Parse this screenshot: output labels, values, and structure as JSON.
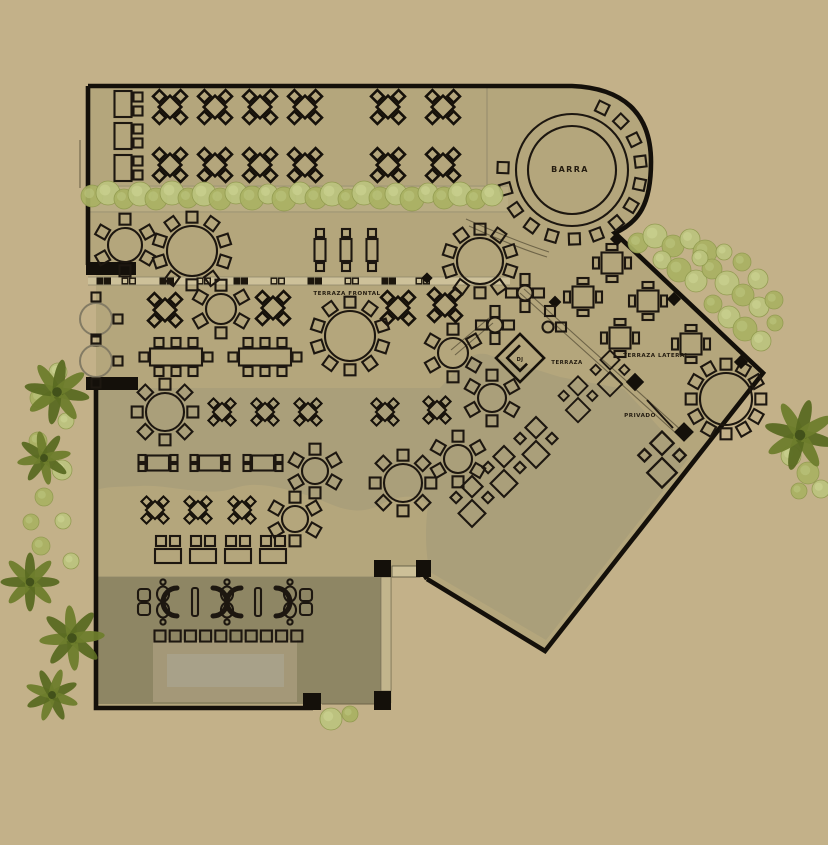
{
  "colors": {
    "page_bg": "#c3b189",
    "interior": "#b4a67c",
    "zone_gray": "#aa9f7a",
    "lounge_zone": "#8e8664",
    "stage_outer": "#a49878",
    "stage_inner": "#a8a189",
    "hedge_band": "#c0b289",
    "divider_strip": "#cdc19a",
    "door_strip": "#c2b58c",
    "line_dark": "#14100a",
    "bush_a": "#aab263",
    "bush_b": "#bcc47f",
    "palm": "#5a6a22"
  },
  "labels": {
    "barra": {
      "text": "BARRA",
      "x": 570,
      "y": 172,
      "size": 8
    },
    "terraza_frontal": {
      "text": "TERRAZA FRONTAL",
      "x": 347,
      "y": 295,
      "size": 5.6
    },
    "terraza": {
      "text": "TERRAZA",
      "x": 567,
      "y": 364,
      "size": 5.4
    },
    "terraza_lateral": {
      "text": "TERRAZA LATERAL",
      "x": 656,
      "y": 357,
      "size": 5.6
    },
    "privado": {
      "text": "PRIVADO",
      "x": 640,
      "y": 417,
      "size": 5.6
    },
    "dj": {
      "text": "DJ",
      "x": 520,
      "y": 361,
      "size": 5
    }
  },
  "furniture": {
    "diamond_tables": [
      {
        "x": 170,
        "y": 107
      },
      {
        "x": 215,
        "y": 107
      },
      {
        "x": 260,
        "y": 107
      },
      {
        "x": 305,
        "y": 107
      },
      {
        "x": 388,
        "y": 107
      },
      {
        "x": 443,
        "y": 107
      },
      {
        "x": 170,
        "y": 165
      },
      {
        "x": 215,
        "y": 165
      },
      {
        "x": 260,
        "y": 165
      },
      {
        "x": 305,
        "y": 165
      },
      {
        "x": 388,
        "y": 165
      },
      {
        "x": 443,
        "y": 165
      },
      {
        "x": 165,
        "y": 310
      },
      {
        "x": 273,
        "y": 308
      },
      {
        "x": 398,
        "y": 308
      },
      {
        "x": 445,
        "y": 305
      },
      {
        "x": 222,
        "y": 412,
        "s": 0.8
      },
      {
        "x": 265,
        "y": 412,
        "s": 0.8
      },
      {
        "x": 308,
        "y": 412,
        "s": 0.8
      },
      {
        "x": 385,
        "y": 412,
        "s": 0.8
      },
      {
        "x": 437,
        "y": 410,
        "s": 0.8
      },
      {
        "x": 155,
        "y": 510,
        "s": 0.8
      },
      {
        "x": 198,
        "y": 510,
        "s": 0.8
      },
      {
        "x": 242,
        "y": 510,
        "s": 0.8
      }
    ],
    "square_tables": [
      {
        "x": 612,
        "y": 263
      },
      {
        "x": 583,
        "y": 297
      },
      {
        "x": 648,
        "y": 301
      },
      {
        "x": 620,
        "y": 338
      },
      {
        "x": 691,
        "y": 344
      }
    ],
    "round_tables": [
      {
        "x": 125,
        "y": 245,
        "r": 17,
        "chairs": 6
      },
      {
        "x": 192,
        "y": 251,
        "r": 25,
        "chairs": 10
      },
      {
        "x": 480,
        "y": 261,
        "r": 23,
        "chairs": 10
      },
      {
        "x": 221,
        "y": 309,
        "r": 15,
        "chairs": 6
      },
      {
        "x": 350,
        "y": 336,
        "r": 25,
        "chairs": 10
      },
      {
        "x": 453,
        "y": 353,
        "r": 15,
        "chairs": 6
      },
      {
        "x": 165,
        "y": 412,
        "r": 19,
        "chairs": 8
      },
      {
        "x": 315,
        "y": 471,
        "r": 13,
        "chairs": 6
      },
      {
        "x": 403,
        "y": 483,
        "r": 19,
        "chairs": 8
      },
      {
        "x": 295,
        "y": 519,
        "r": 13,
        "chairs": 6
      },
      {
        "x": 492,
        "y": 398,
        "r": 14,
        "chairs": 6
      },
      {
        "x": 458,
        "y": 459,
        "r": 14,
        "chairs": 6
      },
      {
        "x": 726,
        "y": 399,
        "r": 26,
        "chairs": 12
      }
    ],
    "faded_round_tables": [
      {
        "x": 96,
        "y": 319,
        "r": 16
      },
      {
        "x": 96,
        "y": 361,
        "r": 16
      }
    ],
    "hightop_tables": [
      {
        "x": 320,
        "y": 250
      },
      {
        "x": 346,
        "y": 250
      },
      {
        "x": 372,
        "y": 250
      }
    ],
    "side_tables": [
      {
        "x": 158,
        "y": 463
      },
      {
        "x": 210,
        "y": 463
      },
      {
        "x": 263,
        "y": 463
      }
    ],
    "banquet_tables": [
      {
        "x": 176,
        "y": 357
      },
      {
        "x": 265,
        "y": 357
      }
    ],
    "lounge_h": [
      {
        "x": 129,
        "y": 104
      },
      {
        "x": 129,
        "y": 136
      },
      {
        "x": 129,
        "y": 168
      }
    ],
    "lounge_v": [
      {
        "x": 168,
        "y": 553
      },
      {
        "x": 203,
        "y": 553
      },
      {
        "x": 238,
        "y": 553
      },
      {
        "x": 273,
        "y": 553
      }
    ],
    "diag_duos": [
      {
        "x": 536,
        "y": 441
      },
      {
        "x": 504,
        "y": 470
      },
      {
        "x": 472,
        "y": 500
      },
      {
        "x": 610,
        "y": 372,
        "s": 0.9
      },
      {
        "x": 578,
        "y": 398,
        "s": 0.9
      },
      {
        "x": 662,
        "y": 458,
        "s": 1.1
      }
    ],
    "round_cross": [
      {
        "x": 525,
        "y": 293
      },
      {
        "x": 495,
        "y": 325
      }
    ],
    "bar": {
      "x": 572,
      "y": 170,
      "outer_r": 56,
      "inner_r": 44,
      "stool_r": 69,
      "stool_angles": [
        64,
        45,
        26,
        7,
        -12,
        -31,
        -50,
        -69,
        -88,
        -107,
        -126,
        -145,
        -164,
        178
      ]
    },
    "dj": {
      "x": 520,
      "y": 358
    },
    "wall_markers": [
      {
        "x": 617,
        "y": 239,
        "s": 10
      },
      {
        "x": 674,
        "y": 299,
        "s": 10
      },
      {
        "x": 741,
        "y": 362,
        "s": 10
      },
      {
        "x": 635,
        "y": 382,
        "s": 13
      },
      {
        "x": 684,
        "y": 432,
        "s": 14
      },
      {
        "x": 555,
        "y": 302,
        "s": 9
      },
      {
        "x": 427,
        "y": 278,
        "s": 8
      }
    ],
    "divider": {
      "y": 281,
      "x1": 88,
      "x2": 510,
      "pairs": [
        {
          "x": 100,
          "f": 1
        },
        {
          "x": 125,
          "f": 0
        },
        {
          "x": 163,
          "f": 1
        },
        {
          "x": 200,
          "f": 0
        },
        {
          "x": 237,
          "f": 1
        },
        {
          "x": 274,
          "f": 0
        },
        {
          "x": 311,
          "f": 1
        },
        {
          "x": 348,
          "f": 0
        },
        {
          "x": 385,
          "f": 1
        },
        {
          "x": 419,
          "f": 0
        }
      ]
    },
    "stool_row": {
      "y": 636,
      "start": 160,
      "step": 15.2,
      "count": 10
    },
    "sofa_row": {
      "y": 602,
      "items": [
        {
          "t": "sqpair",
          "x": 144
        },
        {
          "t": "circpair",
          "x": 163
        },
        {
          "t": "arcL",
          "x": 181
        },
        {
          "t": "bar",
          "x": 195
        },
        {
          "t": "arcR",
          "x": 209
        },
        {
          "t": "circpair",
          "x": 227
        },
        {
          "t": "arcL",
          "x": 245
        },
        {
          "t": "bar",
          "x": 258
        },
        {
          "t": "arcR",
          "x": 272
        },
        {
          "t": "circpair",
          "x": 290
        },
        {
          "t": "sqpair",
          "x": 306
        }
      ]
    },
    "wall_stub_items": [
      {
        "t": "stool",
        "x": 550,
        "y": 311
      },
      {
        "t": "minibar",
        "x": 553,
        "y": 327
      }
    ]
  },
  "landscape": {
    "palms": [
      {
        "x": 57,
        "y": 392,
        "r": 40,
        "rot": 10
      },
      {
        "x": 44,
        "y": 458,
        "r": 33,
        "rot": 35
      },
      {
        "x": 30,
        "y": 582,
        "r": 36,
        "rot": 0
      },
      {
        "x": 72,
        "y": 638,
        "r": 40,
        "rot": 40
      },
      {
        "x": 52,
        "y": 695,
        "r": 33,
        "rot": -25
      },
      {
        "x": 800,
        "y": 435,
        "r": 44,
        "rot": 15
      }
    ],
    "bushes": [
      [
        92,
        196,
        11,
        0
      ],
      [
        108,
        193,
        12,
        1
      ],
      [
        124,
        199,
        10,
        0
      ],
      [
        140,
        194,
        12,
        1
      ],
      [
        156,
        199,
        11,
        0
      ],
      [
        172,
        193,
        12,
        1
      ],
      [
        188,
        198,
        10,
        0
      ],
      [
        204,
        194,
        12,
        1
      ],
      [
        220,
        199,
        11,
        0
      ],
      [
        236,
        193,
        11,
        1
      ],
      [
        252,
        198,
        12,
        0
      ],
      [
        268,
        194,
        10,
        1
      ],
      [
        284,
        199,
        12,
        0
      ],
      [
        300,
        193,
        11,
        1
      ],
      [
        316,
        198,
        11,
        0
      ],
      [
        332,
        194,
        12,
        1
      ],
      [
        348,
        199,
        10,
        0
      ],
      [
        364,
        193,
        12,
        1
      ],
      [
        380,
        198,
        11,
        0
      ],
      [
        396,
        194,
        11,
        1
      ],
      [
        412,
        199,
        12,
        0
      ],
      [
        428,
        193,
        10,
        1
      ],
      [
        444,
        198,
        11,
        0
      ],
      [
        460,
        194,
        12,
        1
      ],
      [
        476,
        199,
        10,
        0
      ],
      [
        492,
        195,
        11,
        1
      ],
      [
        638,
        243,
        10,
        0
      ],
      [
        655,
        236,
        12,
        1
      ],
      [
        673,
        246,
        11,
        0
      ],
      [
        690,
        239,
        10,
        1
      ],
      [
        705,
        252,
        12,
        0
      ],
      [
        662,
        260,
        9,
        1
      ],
      [
        679,
        270,
        12,
        0
      ],
      [
        696,
        281,
        11,
        1
      ],
      [
        712,
        269,
        10,
        0
      ],
      [
        727,
        283,
        12,
        1
      ],
      [
        743,
        295,
        11,
        0
      ],
      [
        759,
        307,
        10,
        1
      ],
      [
        713,
        304,
        9,
        0
      ],
      [
        729,
        317,
        11,
        1
      ],
      [
        745,
        329,
        12,
        0
      ],
      [
        761,
        341,
        10,
        1
      ],
      [
        774,
        300,
        9,
        0
      ],
      [
        758,
        279,
        10,
        1
      ],
      [
        742,
        262,
        9,
        0
      ],
      [
        724,
        252,
        8,
        1
      ],
      [
        775,
        323,
        8,
        0
      ],
      [
        700,
        258,
        8,
        1
      ],
      [
        791,
        456,
        10,
        1
      ],
      [
        808,
        473,
        11,
        0
      ],
      [
        821,
        489,
        9,
        1
      ],
      [
        799,
        491,
        8,
        0
      ],
      [
        331,
        719,
        11,
        1
      ],
      [
        350,
        714,
        8,
        0
      ],
      [
        58,
        372,
        9,
        1
      ],
      [
        40,
        398,
        10,
        0
      ],
      [
        66,
        421,
        8,
        1
      ],
      [
        38,
        441,
        9,
        0
      ],
      [
        62,
        470,
        10,
        1
      ],
      [
        44,
        497,
        9,
        0
      ],
      [
        63,
        521,
        8,
        1
      ],
      [
        41,
        546,
        9,
        0
      ],
      [
        71,
        561,
        8,
        1
      ],
      [
        31,
        522,
        8,
        0
      ]
    ]
  }
}
